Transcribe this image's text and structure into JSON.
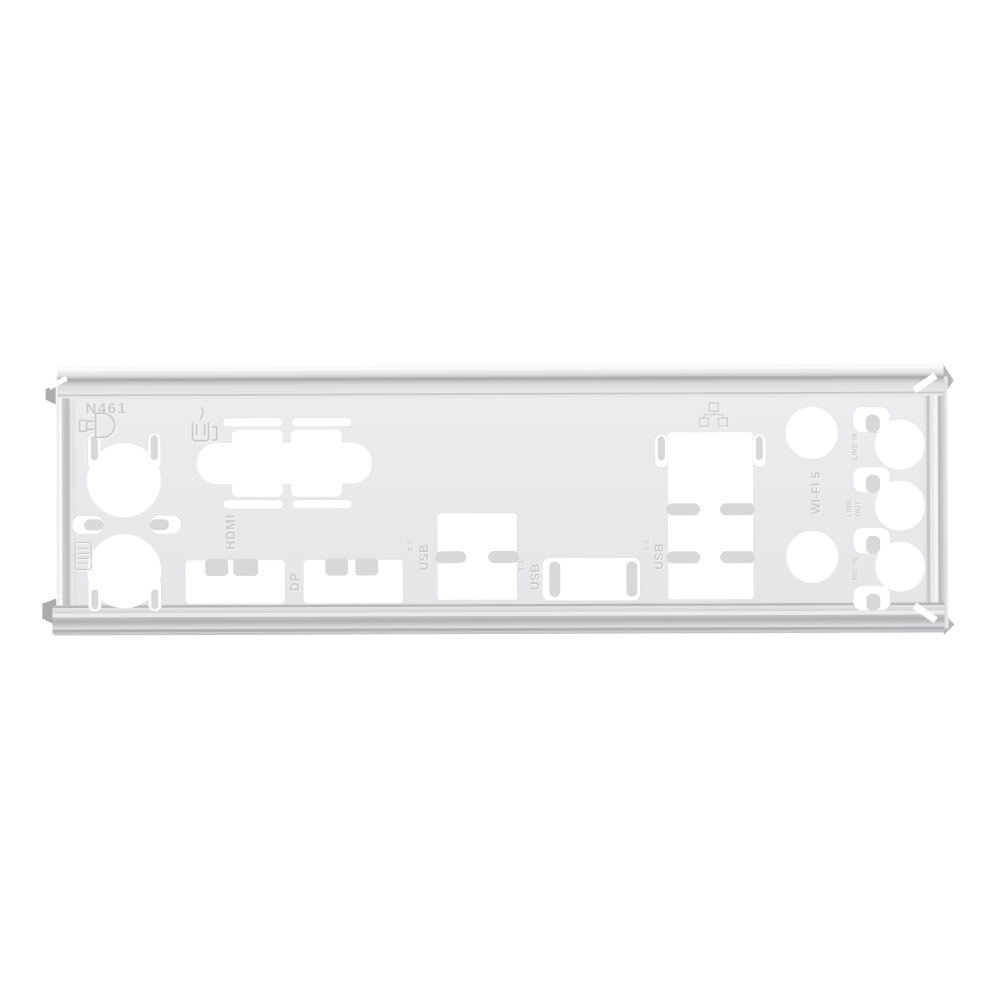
{
  "product": {
    "description": "Silver motherboard rear I/O shield blanking plate photographed on a white background"
  },
  "plate": {
    "part_number": "N461",
    "face_color": "#e9e9eb",
    "cutout_color": "#ffffff",
    "metal_light": "#f8f8f9",
    "metal_mid": "#c3c3c6",
    "metal_dark": "#9a9a9d",
    "emboss_color": "#c9c9cd",
    "tab_color": "#d8d8db"
  },
  "stamps": {
    "part_number": "N461",
    "hdmi": "HDMI",
    "dp": "DP",
    "usb_word": "USB",
    "usb_version": "3.2",
    "wifi": "WI-FI 5",
    "line_in": "LINE IN",
    "line_out_line1": "LINE",
    "line_out_line2": "OUT",
    "mic_in": "MIC IN"
  },
  "icons": [
    "ps2-connector-icon",
    "com-port-icon",
    "lan-icon",
    "connector-stamp-icon"
  ]
}
